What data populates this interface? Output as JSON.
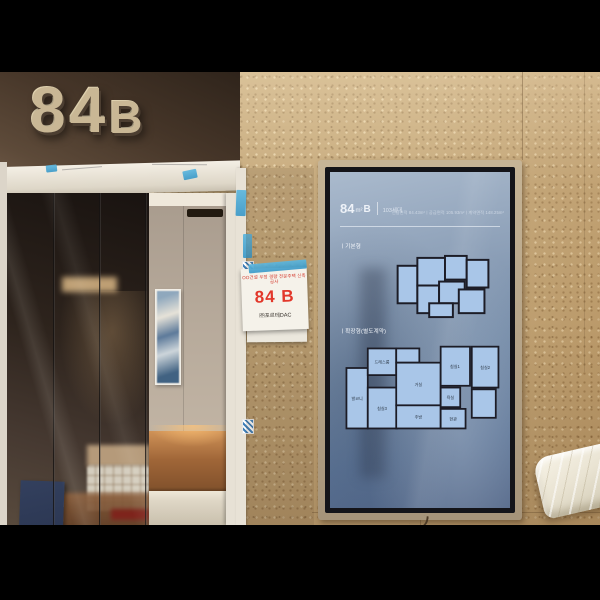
{
  "wall_sign": {
    "number": "84",
    "letter": "B"
  },
  "paper_sign": {
    "header": "OO건설 우정 경량 전문주택 신축공사",
    "unit": "84 B",
    "company": "㈜포르테DAC"
  },
  "screen": {
    "header": {
      "area": "84",
      "area_unit": "m²",
      "type": "B",
      "households": "103세대",
      "specs": "전용면적 84.43m²ㅣ공급면적 105.93m²ㅣ계약면적 148.25m²"
    },
    "section_basic": "ㅣ기본형",
    "section_extended": "ㅣ확장형(별도계약)",
    "rooms": {
      "living": "거실",
      "kitchen": "주방",
      "bed1": "침실1",
      "bed2": "침실2",
      "bed3": "침실3",
      "bath": "욕실",
      "entry": "현관",
      "balcony": "발코니",
      "dress": "드레스룸"
    }
  },
  "colors": {
    "accent_red": "#e2372a",
    "tape_blue": "#45a9d6",
    "screen_blue": "#7289a6",
    "plan_fill": "#a9c6e8",
    "wall_brown": "#453528",
    "stone_beige": "#c3a678",
    "letter_beige": "#c9b795"
  }
}
